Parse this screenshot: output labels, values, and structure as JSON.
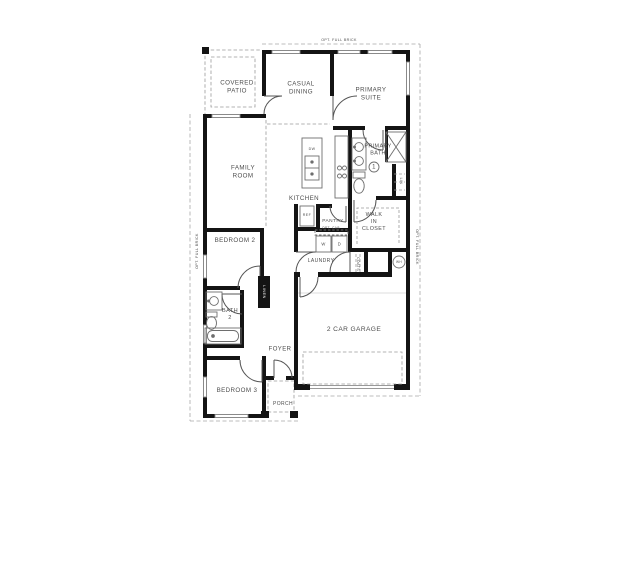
{
  "colors": {
    "wall": "#141414",
    "text": "#4d4d4d",
    "fixture_line": "#6e6e6e",
    "dash_line": "#9b9b9b",
    "background": "#ffffff"
  },
  "rooms": {
    "covered_patio": "COVERED\nPATIO",
    "casual_dining": "CASUAL\nDINING",
    "primary_suite": "PRIMARY\nSUITE",
    "family_room": "FAMILY\nROOM",
    "primary_bath": "PRIMARY\nBATH",
    "kitchen": "KITCHEN",
    "pantry": "PANTRY",
    "laundry": "LAUNDRY",
    "walk_in_closet": "WALK\nIN\nCLOSET",
    "bedroom_2": "BEDROOM 2",
    "bath_2": "BATH\n2",
    "foyer": "FOYER",
    "bedroom_3": "BEDROOM 3",
    "porch": "PORCH",
    "garage": "2 CAR GARAGE"
  },
  "fixtures": {
    "dishwasher": "DW",
    "refrigerator": "REF",
    "washer": "W",
    "dryer": "D",
    "water_heater": "WH",
    "linen_hall": "LINEN",
    "linen_bath": "LIN",
    "coats": "COATS",
    "opt_cabinet": "OPT. CAB"
  },
  "annotations": {
    "opt_full_brick": "OPT. FULL BRICK",
    "keynote_1": "1"
  }
}
